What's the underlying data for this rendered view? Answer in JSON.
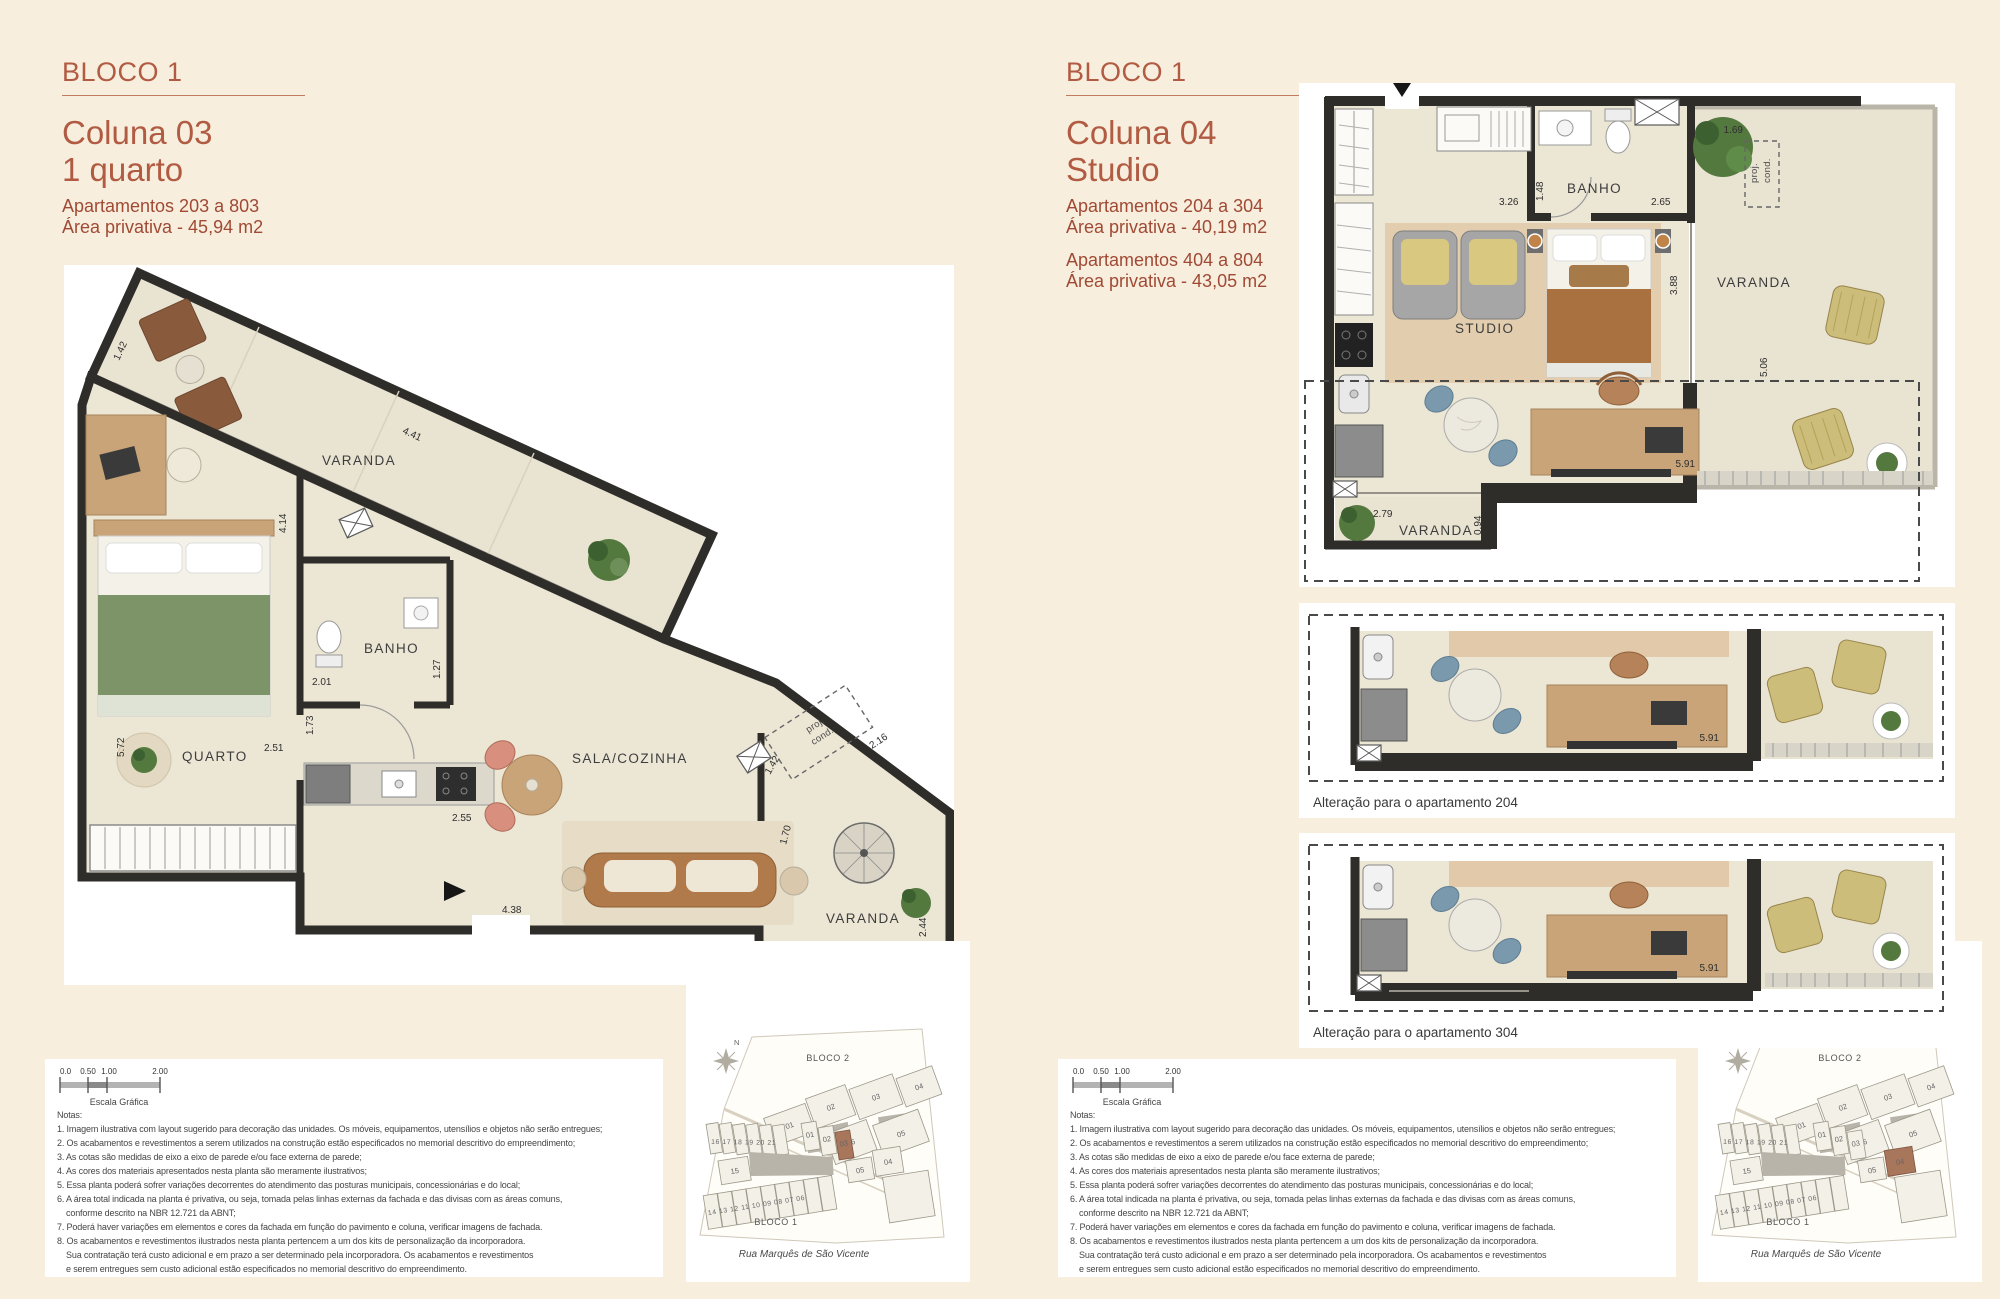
{
  "page": {
    "bg": "#f7eedd",
    "accent": "#b15b43",
    "accent_dark": "#a04a35"
  },
  "left": {
    "block": "BLOCO 1",
    "column": "Coluna 03",
    "type": "1 quarto",
    "apartments": [
      {
        "range": "Apartamentos 203 a 803",
        "area": "Área privativa - 45,94 m2"
      }
    ],
    "plan": {
      "rooms": {
        "varanda_top": "VARANDA",
        "quarto": "QUARTO",
        "banho": "BANHO",
        "sala": "SALA/COZINHA",
        "varanda_br": "VARANDA",
        "proj": "proj.",
        "cond": "cond."
      },
      "dims": {
        "d1_42a": "1.42",
        "d4_41": "4.41",
        "d4_14": "4.14",
        "d2_01": "2.01",
        "d1_73": "1.73",
        "d1_27": "1.27",
        "d5_72": "5.72",
        "d2_51": "2.51",
        "d2_55": "2.55",
        "d4_38": "4.38",
        "d1_69": "1.69",
        "d2_44": "2.44",
        "d2_16": "2.16",
        "d1_42b": "1.42",
        "d1_70": "1.70"
      }
    }
  },
  "right": {
    "block": "BLOCO 1",
    "column": "Coluna 04",
    "type": "Studio",
    "apartments": [
      {
        "range": "Apartamentos 204 a 304",
        "area": "Área privativa - 40,19 m2"
      },
      {
        "range": "Apartamentos 404 a 804",
        "area": "Área privativa - 43,05 m2"
      }
    ],
    "plan": {
      "rooms": {
        "banho": "BANHO",
        "studio": "STUDIO",
        "varanda_r": "VARANDA",
        "varanda_b": "VARANDA",
        "proj": "proj.",
        "cond": "cond."
      },
      "dims": {
        "d3_26": "3.26",
        "d1_48": "1.48",
        "d2_65": "2.65",
        "d1_69": "1.69",
        "d3_88": "3.88",
        "d5_06": "5.06",
        "d5_91": "5.91",
        "d2_79": "2.79",
        "d0_94": "0.94"
      }
    },
    "alterations": [
      "Alteração para o apartamento 204",
      "Alteração para o apartamento 304"
    ],
    "alt_dim": "5.91"
  },
  "scale": {
    "t0": "0.0",
    "t05": "0.50",
    "t1": "1.00",
    "t2": "2.00",
    "label": "Escala Gráfica"
  },
  "notes": {
    "title": "Notas:",
    "lines": [
      "1. Imagem ilustrativa com layout sugerido para decoração das unidades. Os móveis, equipamentos, utensílios e objetos não serão entregues;",
      "2. Os acabamentos e revestimentos a serem utilizados na construção estão especificados no memorial descritivo do empreendimento;",
      "3. As cotas são medidas de eixo a eixo de parede e/ou face externa de parede;",
      "4. As cores dos materiais apresentados nesta planta são meramente ilustrativos;",
      "5. Essa planta poderá sofrer variações decorrentes do atendimento das posturas municipais, concessionárias e do local;",
      "6. A área total indicada na planta é privativa, ou seja, tomada pelas linhas externas da fachada e das divisas com as áreas comuns,",
      "conforme descrito na NBR 12.721 da ABNT;",
      "7. Poderá haver variações em elementos e cores da fachada em função do pavimento e coluna, verificar imagens de fachada.",
      "8. Os acabamentos e revestimentos ilustrados nesta planta pertencem a um dos kits de personalização da incorporadora.",
      "Sua contratação terá custo adicional e em prazo a ser determinado pela incorporadora. Os acabamentos e revestimentos",
      "e serem entregues sem custo adicional estão especificados  no memorial descritivo do empreendimento."
    ]
  },
  "sitemap": {
    "north": "N",
    "bloco2_label": "BLOCO 2",
    "bloco1_label": "BLOCO 1",
    "street": "Rua Marquês de São Vicente",
    "b2": [
      "01",
      "02",
      "03",
      "04",
      "06",
      "05"
    ],
    "b1_top_row": "16 17 18 19 20 21",
    "b1_bottom_row": "14 13 12 11 10 09 08 07 06",
    "b1_15": "15",
    "b1_01": "01",
    "b1_02": "02",
    "b1_03": "03",
    "b1_05": "05",
    "b1_04": "04"
  }
}
